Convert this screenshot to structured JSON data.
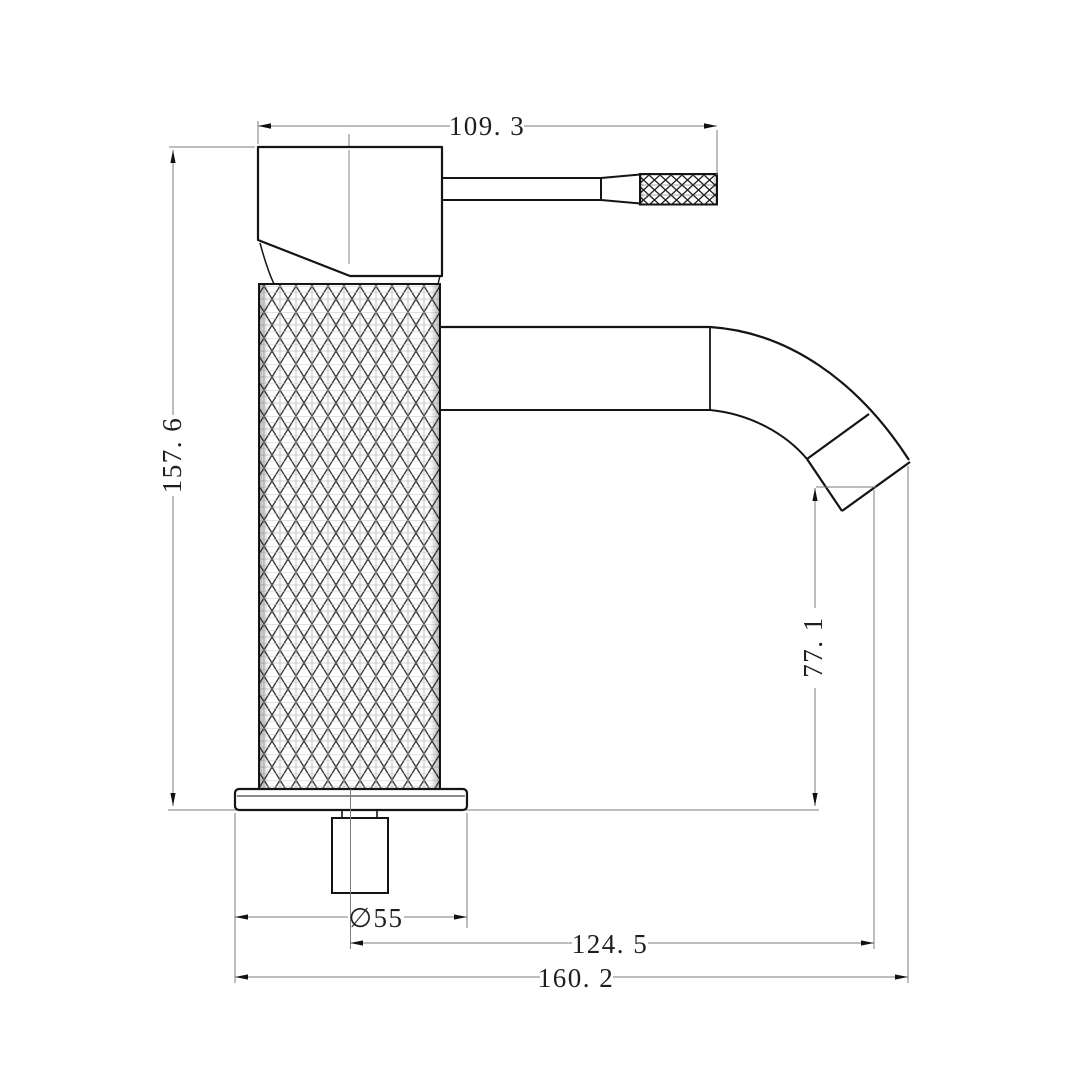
{
  "drawing": {
    "background_color": "#ffffff",
    "object_line_color": "#141414",
    "dimension_line_color": "#7d7d7d",
    "text_color": "#1f1f1f",
    "dimensions": {
      "handle_reach": {
        "label": "109. 3",
        "value": 109.3
      },
      "overall_height": {
        "label": "157. 6",
        "value": 157.6
      },
      "outlet_height": {
        "label": "77. 1",
        "value": 77.1
      },
      "base_diameter": {
        "label": "∅55",
        "value": 55
      },
      "outlet_reach": {
        "label": "124. 5",
        "value": 124.5
      },
      "overall_reach": {
        "label": "160. 2",
        "value": 160.2
      }
    }
  }
}
